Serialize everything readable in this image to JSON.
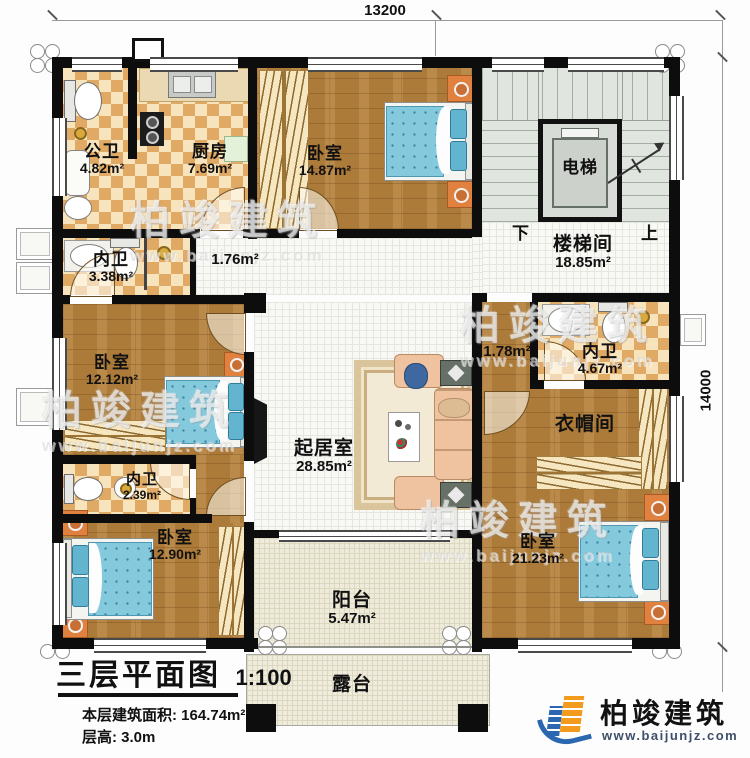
{
  "dimensions": {
    "width_label": "13200",
    "height_label": "14000"
  },
  "rooms": {
    "public_bath": {
      "name": "公卫",
      "area": "4.82m²"
    },
    "kitchen": {
      "name": "厨房",
      "area": "7.69m²"
    },
    "bedroom_top": {
      "name": "卧室",
      "area": "14.87m²"
    },
    "elevator": {
      "name": "电梯"
    },
    "stairwell": {
      "name": "楼梯间",
      "area": "18.85m²",
      "down_label": "下",
      "up_label": "上"
    },
    "ensuite_left": {
      "name": "内卫",
      "area": "3.38m²"
    },
    "hall_small": {
      "area": "1.76m²"
    },
    "bedroom_left": {
      "name": "卧室",
      "area": "12.12m²"
    },
    "living": {
      "name": "起居室",
      "area": "28.85m²"
    },
    "hall_right": {
      "area": "1.78m²"
    },
    "ensuite_right": {
      "name": "内卫",
      "area": "4.67m²"
    },
    "cloakroom": {
      "name": "衣帽间"
    },
    "ensuite_lower": {
      "name": "内卫",
      "area": "2.39m²"
    },
    "bedroom_bottom_left": {
      "name": "卧室",
      "area": "12.90m²"
    },
    "bedroom_bottom_right": {
      "name": "卧室",
      "area": "21.23m²"
    },
    "balcony": {
      "name": "阳台",
      "area": "5.47m²"
    },
    "terrace": {
      "name": "露台"
    }
  },
  "title_block": {
    "title": "三层平面图",
    "scale": "1:100",
    "floor_area": "本层建筑面积: 164.74m²",
    "floor_height": "层高: 3.0m"
  },
  "logo": {
    "company": "柏竣建筑",
    "website": "www.baijunjz.com"
  },
  "watermark": {
    "text": "柏竣建筑",
    "url": "www.baijunjz.com"
  },
  "colors": {
    "wall": "#0d0d0d",
    "wood": "#b5813c",
    "tile": "#e0a964",
    "bed": "#85c9dd",
    "sofa": "#f0c3a0",
    "logo_orange": "#f29b1d",
    "logo_blue": "#2a67b0"
  }
}
